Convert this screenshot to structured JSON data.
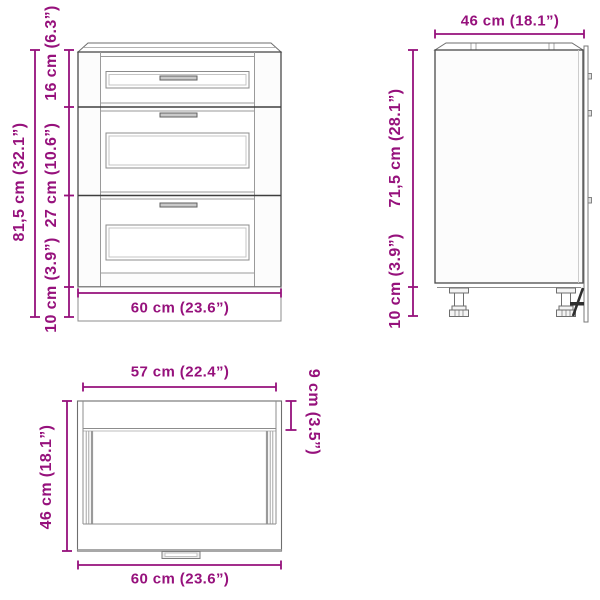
{
  "colors": {
    "dimension": "#96117C",
    "outline_dark": "#3e3e3e",
    "outline_mid": "#6e6e6e",
    "outline_light": "#9a9a9a",
    "handle_fill": "#c9c9c9",
    "clip_dark": "#2e2e2e",
    "background": "#ffffff"
  },
  "views": {
    "front": {
      "dim_total_height": "81,5 cm (32.1”)",
      "dim_drawer_top": "16 cm (6.3”)",
      "dim_drawer_mid": "27 cm (10.6”)",
      "dim_plinth": "10 cm (3.9”)",
      "dim_width": "60 cm (23.6”)"
    },
    "side": {
      "dim_depth": "46 cm (18.1”)",
      "dim_body_height": "71,5 cm (28.1”)",
      "dim_leg_height": "10 cm (3.9”)"
    },
    "top": {
      "dim_inner_width": "57 cm (22.4”)",
      "dim_depth": "46 cm (18.1”)",
      "dim_front_offset": "9 cm (3.5”)",
      "dim_outer_width": "60 cm (23.6”)"
    }
  }
}
